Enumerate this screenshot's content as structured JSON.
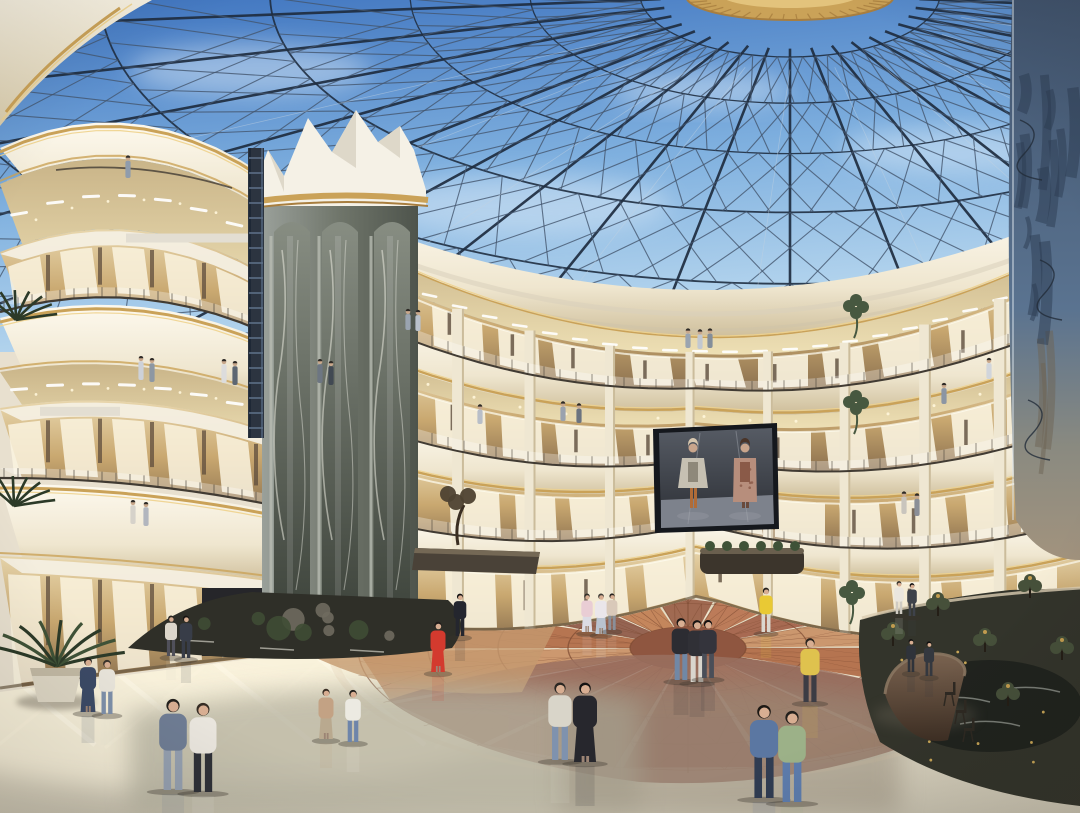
{
  "scene": {
    "description": "Architectural rendering of a luxury shopping mall atrium: multi-level curved balconies with gold trim, a steel diagrid glass dome with blue sky, a tall marble elevator tower, a hanging LED screen showing two runway fashion models, a decorative terracotta lotus floor medallion, potted plants, a curved stone reception desk and many shoppers walking on the polished floor."
  },
  "palette": {
    "skyTop": "#3f74bf",
    "skyMid": "#7fb0df",
    "skyLow": "#b9d8ef",
    "cloud": "#e3eff9",
    "steelDark": "#1f2d40",
    "steelMid": "#44566e",
    "steelLight": "#c3d2e0",
    "creamLight": "#f7f1e1",
    "cream": "#ece2c9",
    "creamShadow": "#d8cbab",
    "creamDark": "#c2b28d",
    "gold": "#caa258",
    "goldLight": "#eed28c",
    "goldDeep": "#a87e3f",
    "soffit": "#e6d6a6",
    "lamp": "#ffffff",
    "shopWarm": "#c9a870",
    "shopGlow": "#faf3df",
    "shopDark": "#5d4c3c",
    "marbleLight": "#a8aea4",
    "marbleMid": "#6f756a",
    "marbleDark": "#474d44",
    "marbleVein": "#e9e9df",
    "bluecol": "#5a7390",
    "bluecolDark": "#2c3c52",
    "bluecolBase": "#a2937e",
    "screenFrame": "#15181d",
    "screenBg": "#4a4f58",
    "runway": "#7d828c",
    "floorCream": "#efe7d1",
    "floorSun": "#f9f2dc",
    "floorOlive": "#b4b09e",
    "floorShade": "#988d7c",
    "terraLine": "#7c4a32",
    "medallionCore": "#8f5640",
    "gardenDark": "#33342b",
    "plantGreen": "#3f5237",
    "plantDark": "#2c3a28",
    "desk": "#5f4a3a",
    "deskDark": "#3e2f24",
    "skin": "#d8ae92",
    "rail": "#413b33"
  },
  "medallion": {
    "cx": 688,
    "cy": 648,
    "squash": 0.37,
    "rings": [
      330,
      260,
      190,
      120,
      58
    ],
    "petalColors": [
      "#b06a45",
      "#8d5846",
      "#c07e52",
      "#9a6048",
      "#b97350",
      "#a26048",
      "#c89066"
    ],
    "spokes": 28
  },
  "storefront_bays": [
    [
      432,
      52
    ],
    [
      498,
      42
    ],
    [
      552,
      64
    ],
    [
      630,
      44
    ],
    [
      688,
      58
    ],
    [
      758,
      50
    ],
    [
      822,
      44
    ],
    [
      878,
      56
    ],
    [
      948,
      44
    ],
    [
      1004,
      40
    ]
  ],
  "people_ground": [
    {
      "x": 88,
      "y": 712,
      "h": 54,
      "top": "#3c4a66",
      "bottom": "#3c4a66",
      "hair": "#221f1c",
      "dress": true
    },
    {
      "x": 107,
      "y": 714,
      "h": 54,
      "top": "#e9e5db",
      "bottom": "#7e90aa",
      "hair": "#3a332c"
    },
    {
      "x": 171,
      "y": 656,
      "h": 40,
      "top": "#dcd6ca",
      "bottom": "#50505a",
      "hair": "#2a2622"
    },
    {
      "x": 186,
      "y": 658,
      "h": 42,
      "top": "#383d48",
      "bottom": "#383d48",
      "hair": "#171412"
    },
    {
      "x": 173,
      "y": 790,
      "h": 92,
      "top": "#6f7d94",
      "bottom": "#95a0b0",
      "hair": "#23201c"
    },
    {
      "x": 203,
      "y": 792,
      "h": 90,
      "top": "#eae6de",
      "bottom": "#2f3138",
      "hair": "#352c24"
    },
    {
      "x": 326,
      "y": 739,
      "h": 50,
      "top": "#c3a284",
      "bottom": "#b9a98f",
      "hair": "#3a2e24",
      "dress": true
    },
    {
      "x": 353,
      "y": 742,
      "h": 52,
      "top": "#eceae2",
      "bottom": "#6e85aa",
      "hair": "#23201c"
    },
    {
      "x": 438,
      "y": 672,
      "h": 50,
      "top": "#d33a2e",
      "bottom": "#d33a2e",
      "hair": "#1e1a18",
      "dress": true
    },
    {
      "x": 460,
      "y": 636,
      "h": 42,
      "top": "#24262e",
      "bottom": "#24262e",
      "hair": "#121010"
    },
    {
      "x": 560,
      "y": 760,
      "h": 78,
      "top": "#d9d5c9",
      "bottom": "#7f92ae",
      "hair": "#2a2622"
    },
    {
      "x": 585,
      "y": 762,
      "h": 80,
      "top": "#27272d",
      "bottom": "#27272d",
      "hair": "#151312",
      "dress": true
    },
    {
      "x": 587,
      "y": 632,
      "h": 38,
      "top": "#e9cdd4",
      "bottom": "#dcdce4",
      "hair": "#33302a",
      "dress": true
    },
    {
      "x": 601,
      "y": 634,
      "h": 40,
      "top": "#eae6ea",
      "bottom": "#b9c2cf",
      "hair": "#44403a",
      "dress": true
    },
    {
      "x": 612,
      "y": 630,
      "h": 36,
      "top": "#d9c9b9",
      "bottom": "#8a8f99",
      "hair": "#26221e"
    },
    {
      "x": 681,
      "y": 680,
      "h": 62,
      "top": "#2c2c32",
      "bottom": "#7188a6",
      "hair": "#1a1614"
    },
    {
      "x": 697,
      "y": 682,
      "h": 62,
      "top": "#303036",
      "bottom": "#d9d5cd",
      "hair": "#181412"
    },
    {
      "x": 708,
      "y": 678,
      "h": 58,
      "top": "#34343c",
      "bottom": "#4a4e58",
      "hair": "#121010"
    },
    {
      "x": 766,
      "y": 632,
      "h": 44,
      "top": "#e9c934",
      "bottom": "#dbd7cf",
      "hair": "#23201c"
    },
    {
      "x": 810,
      "y": 702,
      "h": 64,
      "top": "#dfc24e",
      "bottom": "#3c3c44",
      "hair": "#2a241e"
    },
    {
      "x": 764,
      "y": 798,
      "h": 94,
      "top": "#5b77a2",
      "bottom": "#303c52",
      "hair": "#1c1814"
    },
    {
      "x": 792,
      "y": 802,
      "h": 92,
      "top": "#9cb188",
      "bottom": "#5d7cac",
      "hair": "#23201c"
    },
    {
      "x": 899,
      "y": 614,
      "h": 32,
      "top": "#eae6de",
      "bottom": "#cfcbc3",
      "hair": "#33302a"
    },
    {
      "x": 912,
      "y": 616,
      "h": 32,
      "top": "#3e424a",
      "bottom": "#3e424a",
      "hair": "#121010"
    },
    {
      "x": 911,
      "y": 672,
      "h": 32,
      "top": "#2f333a",
      "bottom": "#2f333a",
      "hair": "#121010"
    },
    {
      "x": 929,
      "y": 676,
      "h": 34,
      "top": "#34383f",
      "bottom": "#34383f",
      "hair": "#121010"
    }
  ],
  "people_balcony": [
    {
      "x": 128,
      "y": 178,
      "h": 24,
      "c": "#8f9cac"
    },
    {
      "x": 141,
      "y": 380,
      "h": 26,
      "c": "#cdd1d8"
    },
    {
      "x": 152,
      "y": 382,
      "h": 26,
      "c": "#8d97a3"
    },
    {
      "x": 224,
      "y": 383,
      "h": 26,
      "c": "#dcdcdc"
    },
    {
      "x": 235,
      "y": 385,
      "h": 26,
      "c": "#5c6672"
    },
    {
      "x": 320,
      "y": 383,
      "h": 26,
      "c": "#6d7682"
    },
    {
      "x": 331,
      "y": 385,
      "h": 26,
      "c": "#414953"
    },
    {
      "x": 408,
      "y": 330,
      "h": 22,
      "c": "#9aa4b0"
    },
    {
      "x": 418,
      "y": 331,
      "h": 22,
      "c": "#b9c0ca"
    },
    {
      "x": 133,
      "y": 524,
      "h": 26,
      "c": "#d6d2ca"
    },
    {
      "x": 146,
      "y": 526,
      "h": 26,
      "c": "#b2b6be"
    },
    {
      "x": 688,
      "y": 348,
      "h": 20,
      "c": "#9aa4b0"
    },
    {
      "x": 700,
      "y": 349,
      "h": 20,
      "c": "#c2c8d0"
    },
    {
      "x": 710,
      "y": 348,
      "h": 20,
      "c": "#848e9a"
    },
    {
      "x": 563,
      "y": 421,
      "h": 20,
      "c": "#9aa2ae"
    },
    {
      "x": 579,
      "y": 423,
      "h": 20,
      "c": "#6b737f"
    },
    {
      "x": 480,
      "y": 424,
      "h": 20,
      "c": "#b8bec8"
    },
    {
      "x": 904,
      "y": 514,
      "h": 24,
      "c": "#c9c5bd"
    },
    {
      "x": 917,
      "y": 516,
      "h": 24,
      "c": "#8b8f97"
    },
    {
      "x": 989,
      "y": 379,
      "h": 22,
      "c": "#d1d5db"
    },
    {
      "x": 944,
      "y": 404,
      "h": 22,
      "c": "#8b95a3"
    }
  ],
  "garden_trees": [
    {
      "x": 893,
      "y": 646
    },
    {
      "x": 938,
      "y": 616
    },
    {
      "x": 985,
      "y": 652
    },
    {
      "x": 1030,
      "y": 598
    },
    {
      "x": 1062,
      "y": 660
    },
    {
      "x": 1008,
      "y": 706
    },
    {
      "x": 922,
      "y": 702
    }
  ],
  "chairs": [
    {
      "x": 949,
      "y": 700
    },
    {
      "x": 960,
      "y": 718
    },
    {
      "x": 968,
      "y": 736
    }
  ],
  "screen": {
    "models": [
      {
        "cx": 693,
        "skin": "#c9a58c",
        "hair": "#d6c6ae",
        "coat": "#c6c0b2",
        "inner": "#8e887a",
        "pants": "#b06c38"
      },
      {
        "cx": 745,
        "skin": "#c9a58c",
        "hair": "#4a3428",
        "coat": "#b78e7c",
        "inner": "#8a5a48",
        "pants": "#6a4a3c"
      }
    ]
  }
}
